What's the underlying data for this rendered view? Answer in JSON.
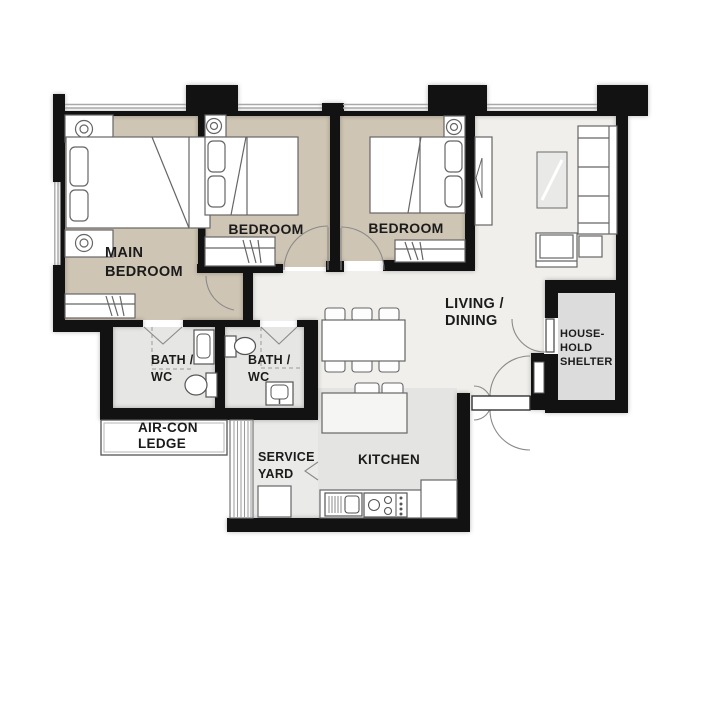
{
  "plan_title": "3-bedroom flat floor plan",
  "rooms": {
    "main_bedroom": {
      "line1": "MAIN",
      "line2": "BEDROOM"
    },
    "bedroom1": {
      "label": "BEDROOM"
    },
    "bedroom2": {
      "label": "BEDROOM"
    },
    "living": {
      "line1": "LIVING /",
      "line2": "DINING"
    },
    "shelter": {
      "line1": "HOUSE-",
      "line2": "HOLD",
      "line3": "SHELTER"
    },
    "bath1": {
      "line1": "BATH /",
      "line2": "WC"
    },
    "bath2": {
      "line1": "BATH /",
      "line2": "WC"
    },
    "aircon": {
      "line1": "AIR-CON",
      "line2": "LEDGE"
    },
    "service_yard": {
      "line1": "SERVICE",
      "line2": "YARD"
    },
    "kitchen": {
      "label": "KITCHEN"
    }
  },
  "palette": {
    "wall": "#121212",
    "bedroom_floor": "#cfc5b4",
    "living_floor": "#f0efeb",
    "wet_area_floor": "#e6e6e4",
    "kitchen_floor": "#e4e4e2",
    "service_floor": "#eaeae8",
    "shelter_floor": "#dcdcdc",
    "furniture_outline": "#666666",
    "door_arc": "#8a8a8a",
    "text": "#1b1b1b"
  }
}
